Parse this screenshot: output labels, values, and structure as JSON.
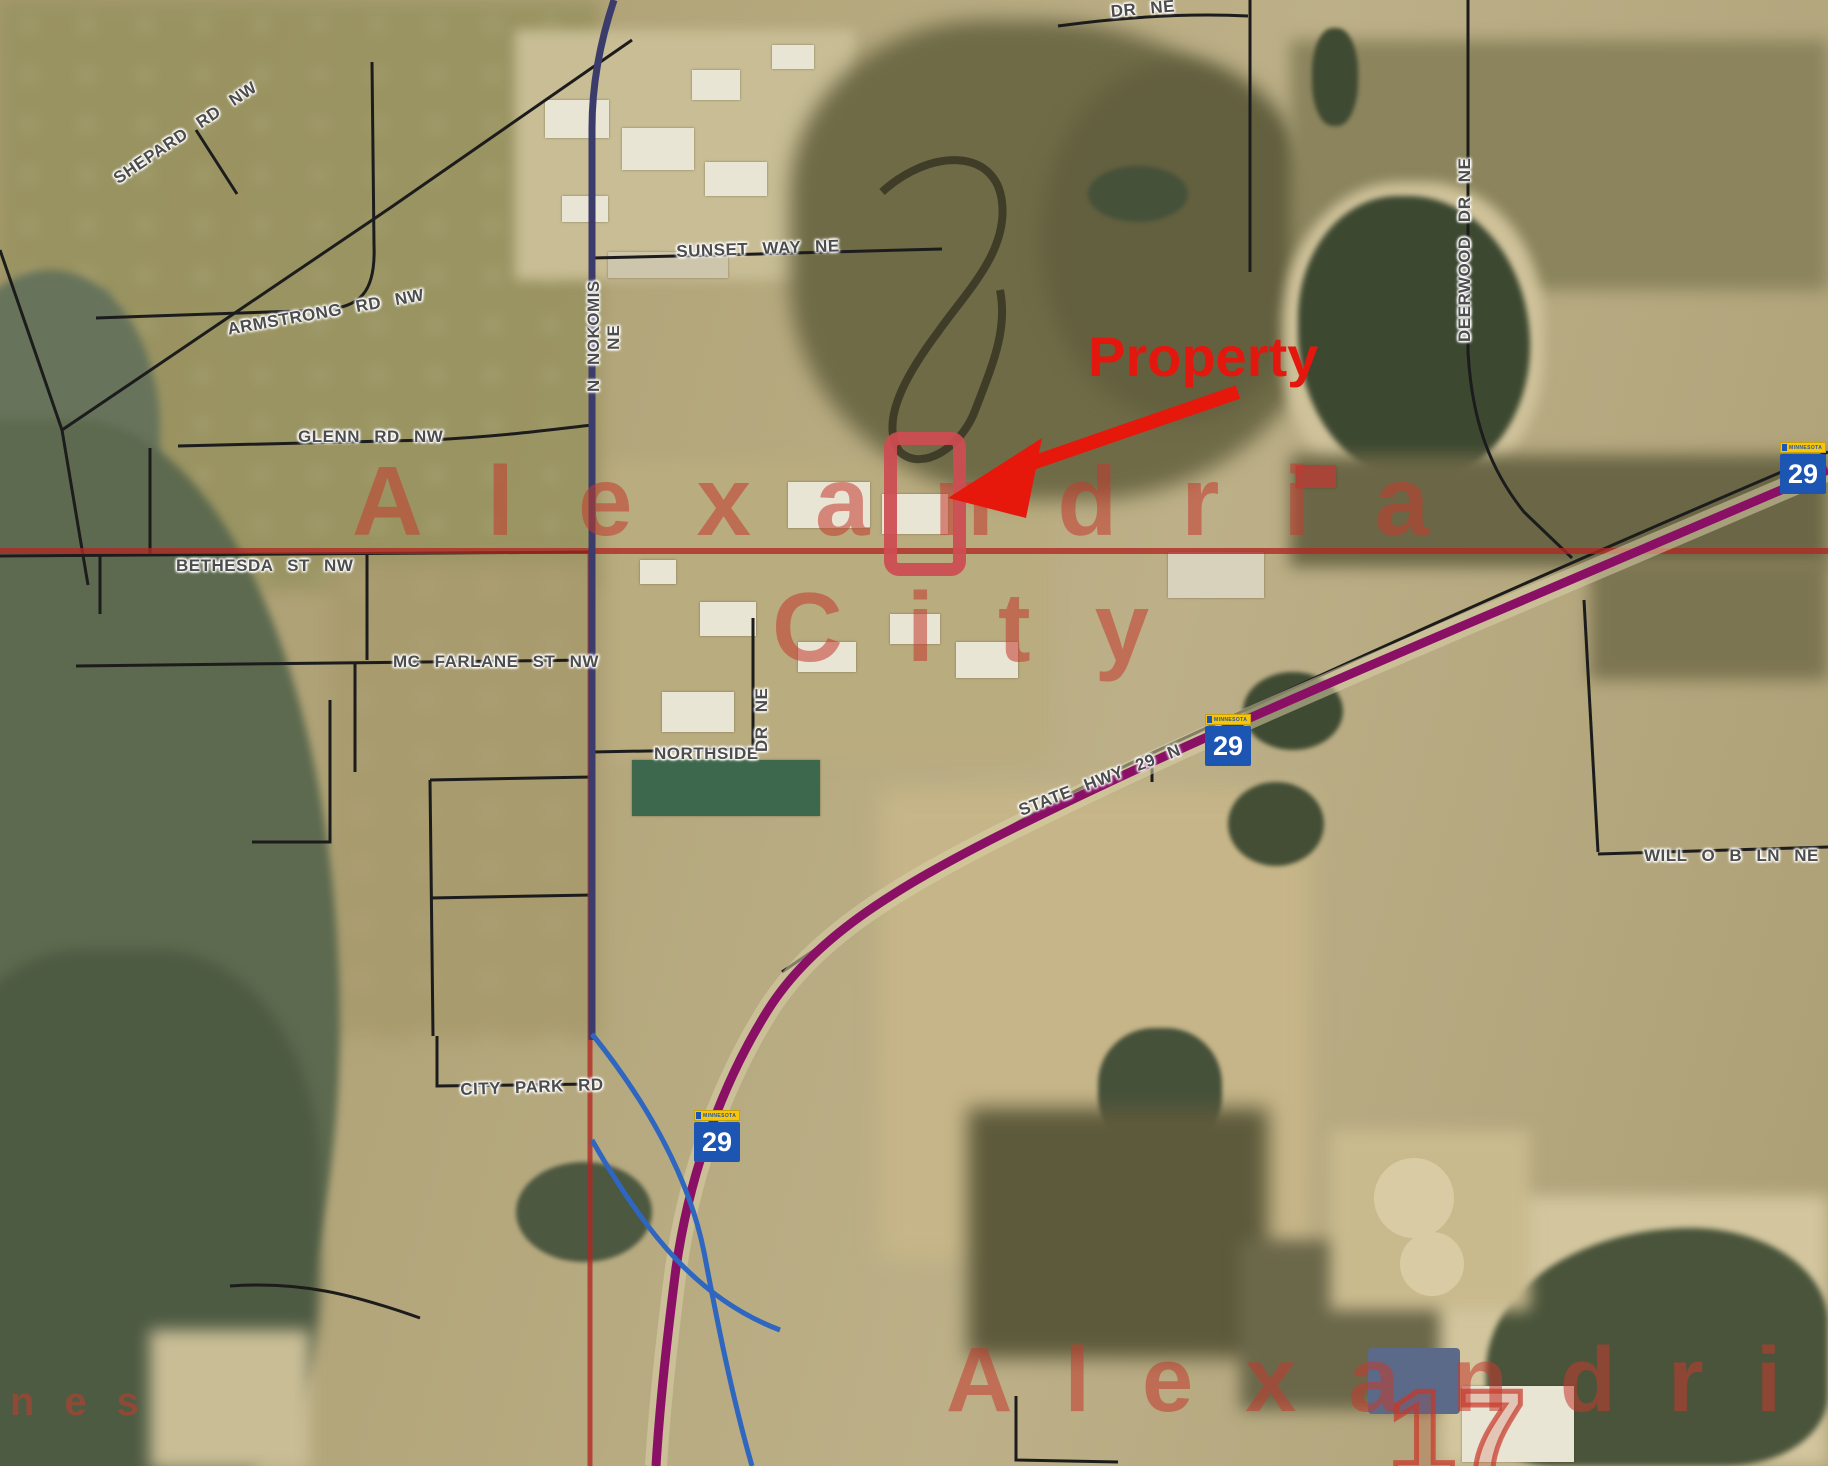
{
  "overlay": {
    "property_label": "Property",
    "city_line1": "Alexandria",
    "city_line2": "City",
    "city_bottom": "Alexandri",
    "route_number_17": "17",
    "edge_fragment": "nes"
  },
  "streets": [
    {
      "text": "SHEPARD RD NW"
    },
    {
      "text": "ARMSTRONG RD NW"
    },
    {
      "text": "GLENN RD NW"
    },
    {
      "text": "BETHESDA ST NW"
    },
    {
      "text": "MC FARLANE ST NW"
    },
    {
      "text": "N NOKOMIS",
      "suffix": "NE"
    },
    {
      "text": "SUNSET WAY NE"
    },
    {
      "text": "NORTHSIDE"
    },
    {
      "text": "DR NE"
    },
    {
      "text": "DEERWOOD DR NE"
    },
    {
      "text": "STATE HWY 29 N"
    },
    {
      "text": "WILL O B LN NE"
    },
    {
      "text": "CITY PARK RD"
    },
    {
      "text": "DR NE"
    }
  ],
  "shields": [
    {
      "banner": "MINNESOTA",
      "number": "29"
    },
    {
      "banner": "MINNESOTA",
      "number": "29"
    },
    {
      "banner": "MINNESOTA",
      "number": "29"
    }
  ],
  "colors": {
    "boundary_red": "#a8231e",
    "highway_purple": "#8a1066",
    "ramp_blue": "#2e66c0",
    "road_black": "#1c1c1c",
    "nokomis_navy": "#3c3c6c",
    "shield_blue": "#1c56b2",
    "shield_banner_yellow": "#f6c50c",
    "annotation_red": "#e6180c",
    "city_overlay_red": "#c23a2d"
  }
}
